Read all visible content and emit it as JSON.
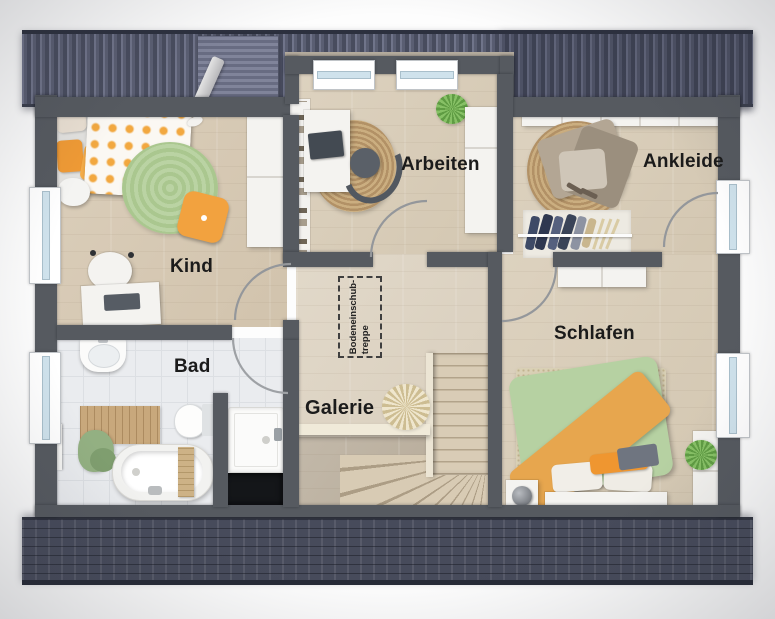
{
  "rooms": {
    "kind": {
      "label": "Kind"
    },
    "arbeiten": {
      "label": "Arbeiten"
    },
    "ankleide": {
      "label": "Ankleide"
    },
    "bad": {
      "label": "Bad"
    },
    "galerie": {
      "label": "Galerie"
    },
    "schlafen": {
      "label": "Schlafen"
    }
  },
  "annotations": {
    "attic_stairs": {
      "line1": "Bodeneinschub-",
      "line2": "treppe"
    }
  },
  "palette": {
    "wall": "#565a60",
    "roof_top": "#545869",
    "roof_bottom": "#474b5b",
    "wood_floor": "#d8ccb7",
    "tile_floor": "#eaecef",
    "rug_green": "#b7d1a0",
    "rug_jute": "#c4a678",
    "bed_orange": "#f2a63e",
    "bed_green": "#b4d0a0",
    "window_glass": "#cfe2ec",
    "label_text": "#1b1b1b"
  }
}
